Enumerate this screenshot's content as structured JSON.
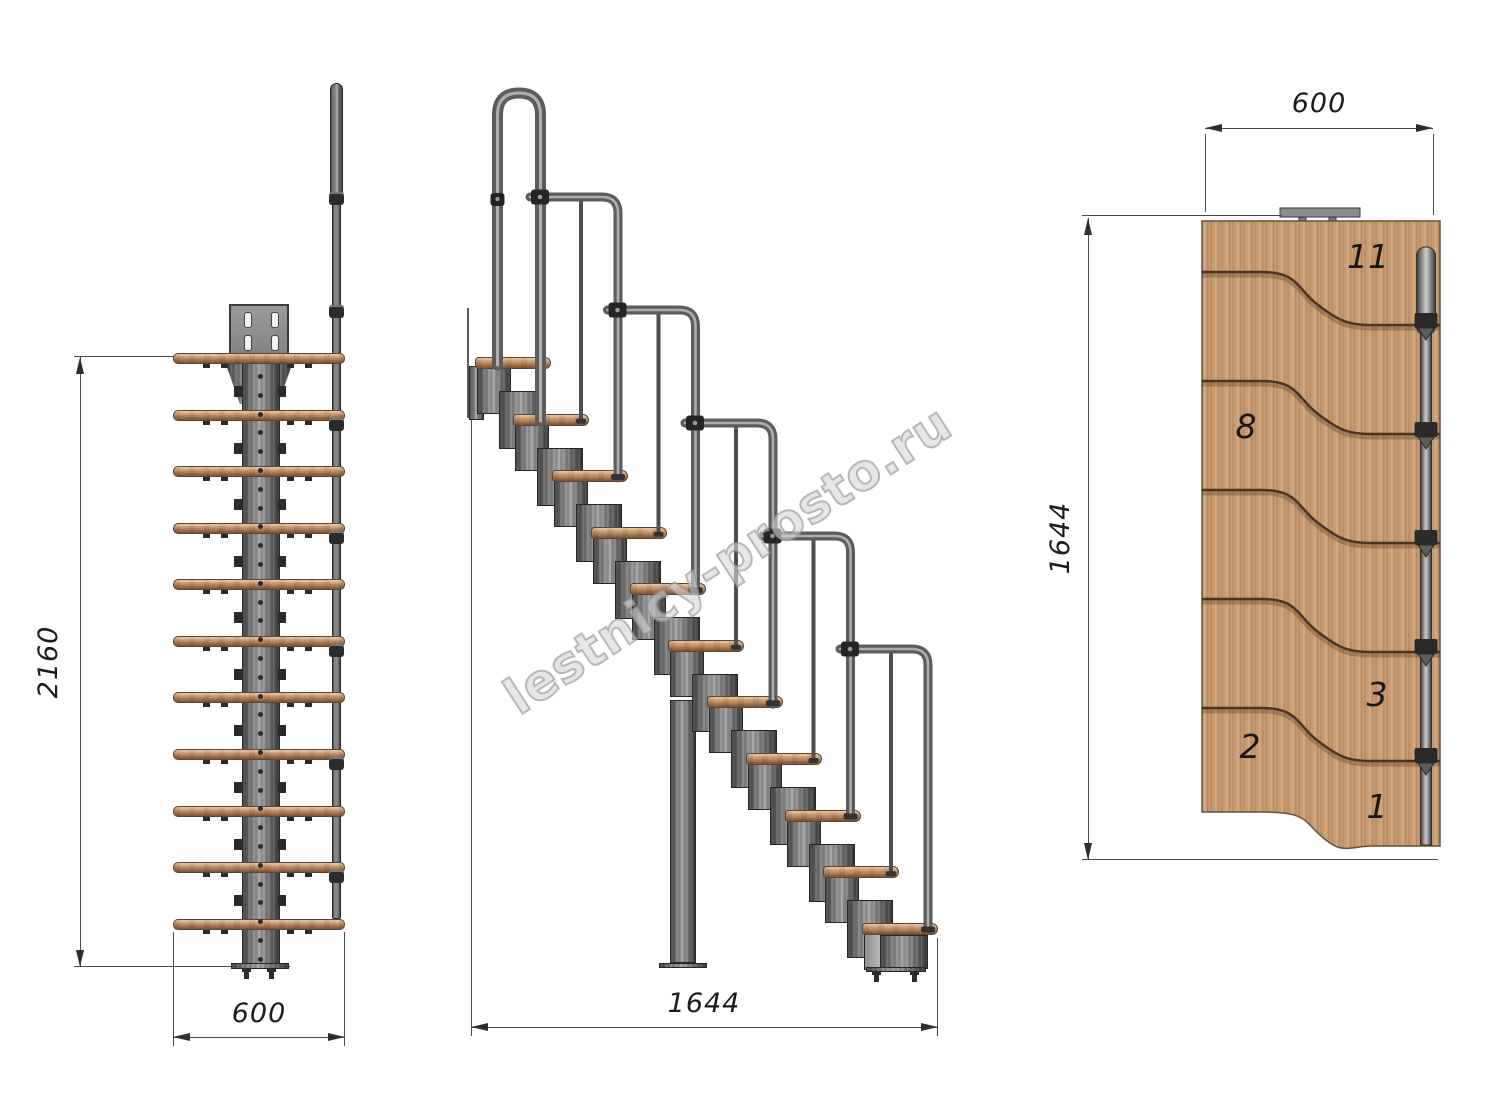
{
  "title": "Modular staircase technical drawing",
  "watermark": {
    "text": "lestnicy-prosto.ru"
  },
  "dimensions": {
    "front_height": "2160",
    "front_width": "600",
    "side_length": "1644",
    "top_width": "600",
    "top_length": "1644"
  },
  "top_view": {
    "tread_numbers": [
      "11",
      "8",
      "3",
      "2",
      "1"
    ]
  },
  "structure": {
    "tread_count": 11,
    "rail_section_count": 5,
    "module_count": 11
  },
  "colors": {
    "wood": "#c89c74",
    "wood_outline": "#5f4530",
    "metal": "#7d7d7d",
    "metal_dark": "#2b2b2b",
    "dimension_line": "#4b4b4b",
    "text": "#1c1c1c",
    "watermark": "#949494",
    "background": "#ffffff"
  }
}
